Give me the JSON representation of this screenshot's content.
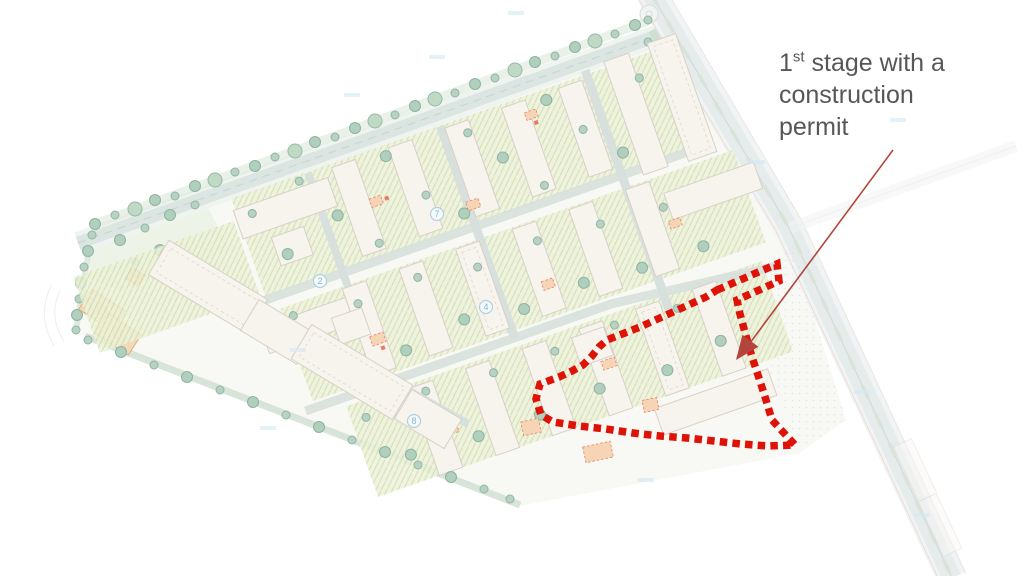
{
  "annotation": {
    "number": "1",
    "ordinal": "st",
    "line1_rest": " stage with a",
    "line2": "construction",
    "line3": "permit",
    "full_text": "1st stage with a construction permit"
  },
  "colors": {
    "stage_boundary_red": "#de1207",
    "arrow_red": "#b2453c",
    "annotation_text_gray": "#57575a"
  },
  "stage_area": {
    "boundary_style": "square-dotted",
    "boundary_points": "717,290 777,264 779,281 737,300 740,314 746,336 752,357 759,378 766,400 772,420 795,445 768,446 741,444 714,441 687,438 660,436 633,433 606,429 579,426 553,422 541,415 536,399 540,384 559,377 572,371 583,365 592,356 599,347 607,340 640,327 673,312 706,297"
  },
  "arrow": {
    "x1": 893,
    "y1": 150,
    "x2": 747,
    "y2": 347,
    "head_points": "736,360 742.4,334.8 758.4,346.8"
  },
  "plan": {
    "unit_labels": [
      "2",
      "7",
      "4",
      "8"
    ]
  }
}
